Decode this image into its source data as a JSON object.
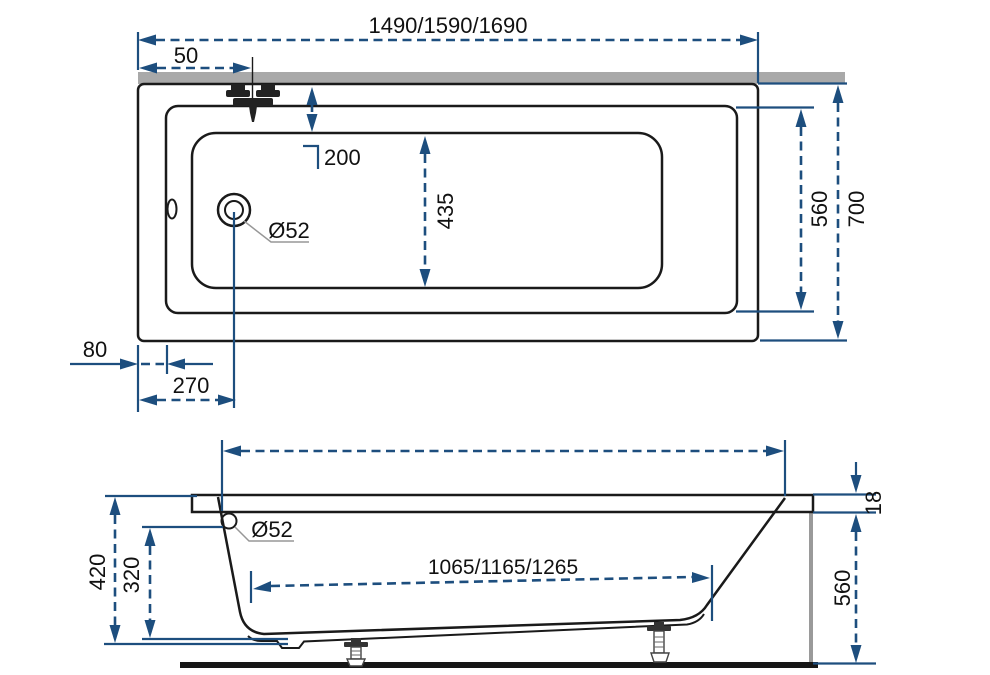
{
  "drawing": {
    "accent_color": "#1d4e7e",
    "line_color": "#1a1a1a",
    "wall_band_color": "#a9a9a9",
    "top_view": {
      "overall_length": "1490/1590/1690",
      "faucet_offset": "50",
      "edge_to_basin": "200",
      "basin_width": "435",
      "drain_diameter": "Ø52",
      "inner_width": "560",
      "overall_width": "700",
      "rim_width": "80",
      "drain_offset": "270"
    },
    "side_view": {
      "overflow_diameter": "Ø52",
      "bottom_length": "1065/1165/1265",
      "overall_height": "420",
      "overflow_height": "320",
      "skirt_height": "560",
      "rim_thickness": "18"
    }
  }
}
